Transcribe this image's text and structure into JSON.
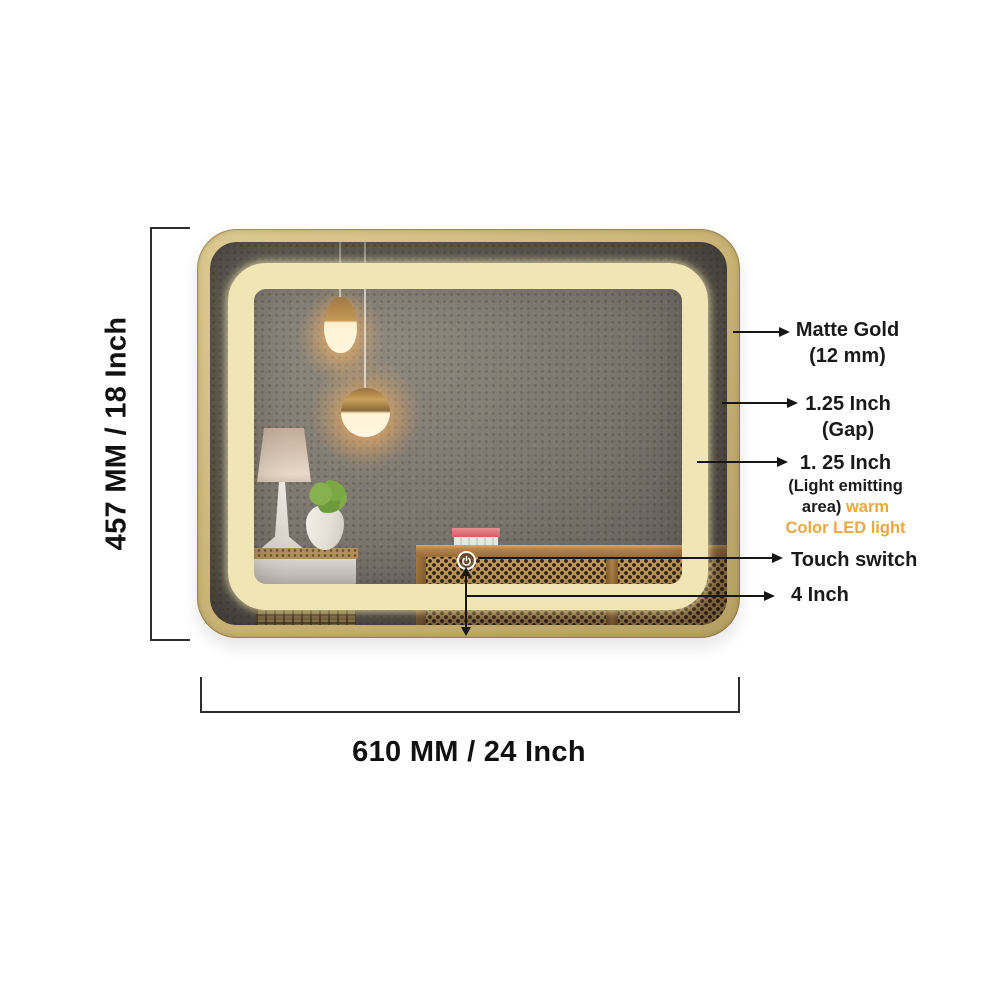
{
  "dimensions": {
    "height_label": "457 MM / 18 Inch",
    "width_label": "610 MM / 24 Inch"
  },
  "callouts": {
    "frame": {
      "title": "Matte Gold",
      "subtitle": "(12 mm)"
    },
    "gap": {
      "title": "1.25 Inch",
      "subtitle": "(Gap)"
    },
    "led": {
      "title": "1. 25 Inch",
      "line2": "(Light emitting",
      "line3_dark": "area)",
      "line3_accent": "warm",
      "line4_accent": "Color LED light"
    },
    "touch_switch": {
      "title": "Touch switch"
    },
    "switch_offset": {
      "title": "4 Inch"
    }
  },
  "colors": {
    "accent_text_orange": "#EAA83E",
    "frame_matte_gold": "#C8B377",
    "led_warm_white": "#EFE5B5",
    "annotation_black": "#161616"
  },
  "icons": {
    "touch_switch": "power-icon"
  }
}
